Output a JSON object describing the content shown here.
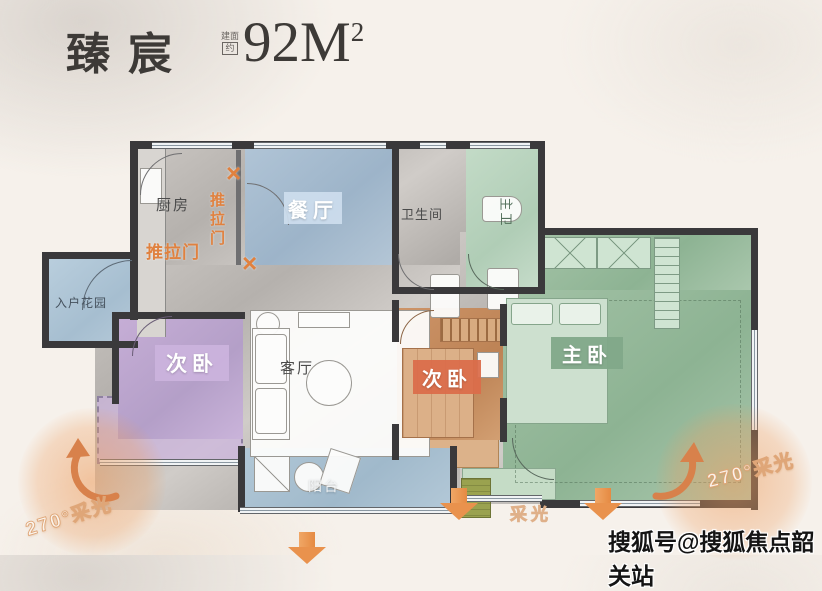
{
  "title": {
    "name": "臻宸",
    "area_prefix_top": "建面",
    "area_prefix_bottom": "约",
    "area_value": "92M",
    "area_sup": "2"
  },
  "rooms": {
    "kitchen": {
      "label": "厨房",
      "color": "#bdb9b5"
    },
    "dining": {
      "label": "餐厅",
      "color": "#a7bed3"
    },
    "bathroom": {
      "label": "卫生间",
      "color": "#b3afab"
    },
    "master_bath": {
      "label": "主卫",
      "color": "#bcd5c0"
    },
    "entry_garden": {
      "label": "入户花园",
      "color": "#b2c8d8"
    },
    "bedroom_left": {
      "label": "次卧",
      "color": "#c0a8d2"
    },
    "living": {
      "label": "客厅",
      "color": "#c9c5c1"
    },
    "bedroom_mid": {
      "label": "次卧",
      "color": "#c78d60"
    },
    "master_bedroom": {
      "label": "主卧",
      "color": "#98bb9e"
    },
    "balcony": {
      "label": "阳台",
      "color": "#a9c1d2"
    }
  },
  "annotations": {
    "sliding_door": "推拉门",
    "cross_mark": "×",
    "daylight": "采光",
    "daylight_270": "270°采光"
  },
  "watermark": "搜狐号@搜狐焦点韶关站",
  "colors": {
    "accent_orange": "#e58a42",
    "sliding_door_orange": "#e0813f",
    "wall_dark": "#3a393b",
    "label_dining_bg": "#cdddee",
    "label_purple_bg": "#cbb2dd",
    "label_orange_bg": "#db6c4a",
    "label_green_bg": "#81a889",
    "background_cream": "#f6f1eb"
  }
}
